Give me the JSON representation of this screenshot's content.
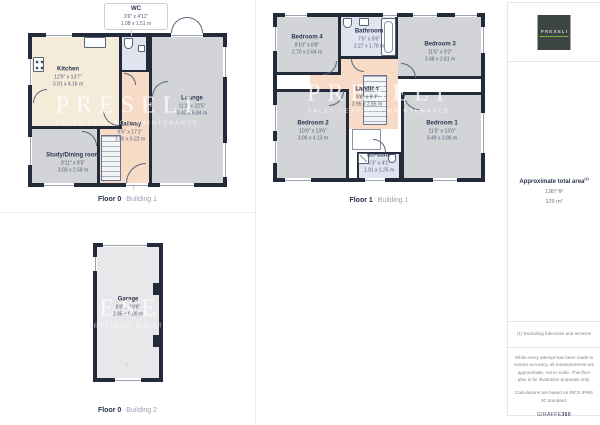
{
  "branding": {
    "logo_text": "PRESELI",
    "watermark_title": "PRESELI",
    "watermark_subtitle": "SALES·LETTINGS·MAINTENANCE",
    "accent_green": "#76b043",
    "wall_color": "#232b3b",
    "room_colors": {
      "kitchen": "#f4ecd9",
      "corridor": "#f8dbc7",
      "room": "#d3d4d8",
      "wet": "#dfe4ef",
      "garage": "#e8e8ea"
    }
  },
  "plans": [
    {
      "caption": {
        "floor": "Floor 0",
        "building": "Building 1"
      },
      "callout": {
        "name": "WC",
        "imperial": "3'6\" x 4'11\"",
        "metric": "1.08 x 1.51 m"
      },
      "rooms": [
        {
          "name": "Kitchen",
          "imperial": "12'9\" x 13'7\"",
          "metric": "3.91 x 4.16 m"
        },
        {
          "name": "Lounge",
          "imperial": "11'3\" x 22'5\"",
          "metric": "3.43 x 6.84 m"
        },
        {
          "name": "Hallway",
          "imperial": "6'5\" x 17'1\"",
          "metric": "1.95 x 5.22 m"
        },
        {
          "name": "Study/Dining room",
          "imperial": "9'11\" x 8'5\"",
          "metric": "3.03 x 2.58 m"
        }
      ]
    },
    {
      "caption": {
        "floor": "Floor 1",
        "building": "Building 1"
      },
      "rooms": [
        {
          "name": "Bedroom 4",
          "imperial": "8'10\" x 8'8\"",
          "metric": "2.70 x 2.64 m"
        },
        {
          "name": "Bathroom",
          "imperial": "7'5\" x 5'6\"",
          "metric": "2.27 x 1.70 m"
        },
        {
          "name": "Bedroom 3",
          "imperial": "11'5\" x 9'2\"",
          "metric": "3.48 x 2.81 m"
        },
        {
          "name": "Landing",
          "imperial": "9'8\" x 9'4\"",
          "metric": "2.95 x 2.85 m"
        },
        {
          "name": "Bedroom 2",
          "imperial": "10'0\" x 13'6\"",
          "metric": "3.06 x 4.13 m"
        },
        {
          "name": "Bedroom 1",
          "imperial": "11'5\" x 13'0\"",
          "metric": "3.49 x 3.96 m"
        },
        {
          "name": "En-suite",
          "imperial": "6'3\" x 4'1\"",
          "metric": "1.91 x 1.25 m"
        }
      ]
    },
    {
      "caption": {
        "floor": "Floor 0",
        "building": "Building 2"
      },
      "rooms": [
        {
          "name": "Garage",
          "imperial": "9'8\" x 19'8\"",
          "metric": "2.95 x 6.00 m"
        }
      ]
    }
  ],
  "sidebar": {
    "total_area": {
      "label": "Approximate total area",
      "footnote_marker": "(1)",
      "sqft": "1387 ft²",
      "sqm": "129 m²"
    },
    "footnote": "(1) Excluding balconies and terraces",
    "disclaimer": "While every attempt has been made to ensure accuracy, all measurements are approximate, not to scale. This floor plan is for illustrative purposes only.",
    "calculations": "Calculations are based on RICS IPMS 3C standard.",
    "brand_name": "GIRAFFE",
    "brand_suffix": "360"
  }
}
